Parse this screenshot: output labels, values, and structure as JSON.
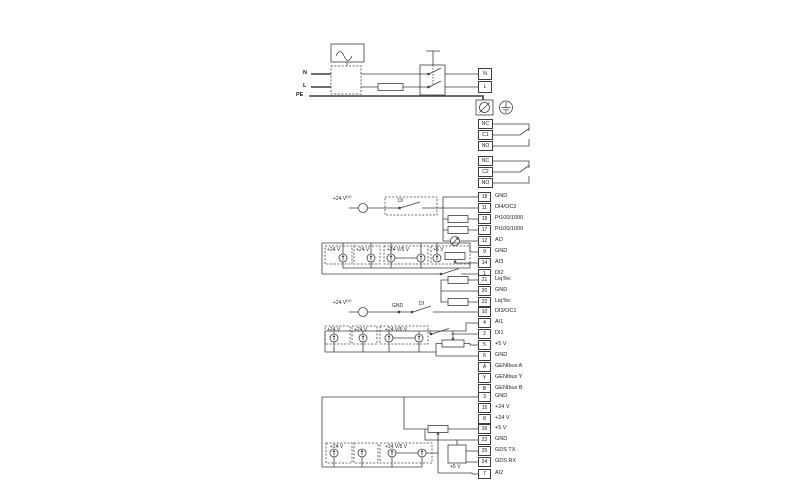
{
  "power": {
    "n_in": "N",
    "l_in": "L",
    "pe": "PE",
    "n_out": "N",
    "l_out": "L"
  },
  "relays": [
    {
      "terminals": [
        "NC",
        "C1",
        "NO"
      ]
    },
    {
      "terminals": [
        "NC",
        "C2",
        "NO"
      ]
    }
  ],
  "terminal_groups": [
    {
      "rows": [
        {
          "id": "18",
          "label": "GND"
        },
        {
          "id": "11",
          "label": "DI4/OC2"
        },
        {
          "id": "19",
          "label": "Pt100/1000"
        },
        {
          "id": "17",
          "label": "Pt100/1000"
        },
        {
          "id": "12",
          "label": "AO"
        },
        {
          "id": "9",
          "label": "GND"
        },
        {
          "id": "14",
          "label": "AI3"
        },
        {
          "id": "1",
          "label": "DI2"
        }
      ]
    },
    {
      "rows": [
        {
          "id": "21",
          "label": "LiqTec"
        },
        {
          "id": "20",
          "label": "GND"
        },
        {
          "id": "22",
          "label": "LiqTec"
        }
      ]
    },
    {
      "rows": [
        {
          "id": "10",
          "label": "DI3/OC1"
        },
        {
          "id": "4",
          "label": "AI1"
        },
        {
          "id": "2",
          "label": "DI1"
        },
        {
          "id": "5",
          "label": "+5 V"
        },
        {
          "id": "6",
          "label": "GND"
        },
        {
          "id": "A",
          "label": "GENIbus A"
        },
        {
          "id": "Y",
          "label": "GENIbus Y"
        },
        {
          "id": "B",
          "label": "GENIbus B"
        }
      ]
    },
    {
      "rows": [
        {
          "id": "3",
          "label": "GND"
        },
        {
          "id": "15",
          "label": "+24 V"
        },
        {
          "id": "8",
          "label": "+24 V"
        }
      ]
    },
    {
      "rows": [
        {
          "id": "26",
          "label": "+5 V"
        },
        {
          "id": "23",
          "label": "GND"
        }
      ]
    },
    {
      "rows": [
        {
          "id": "25",
          "label": "GDS TX"
        },
        {
          "id": "24",
          "label": "GDS RX"
        }
      ]
    },
    {
      "rows": [
        {
          "id": "7",
          "label": "AI2"
        }
      ]
    }
  ],
  "annotations": {
    "plus24v": "+24 V",
    "dc_sup": "DC",
    "di": "DI",
    "gnd": "GND",
    "plus24v5v": "+24 V/5 V",
    "plus5v": "+5 V"
  }
}
